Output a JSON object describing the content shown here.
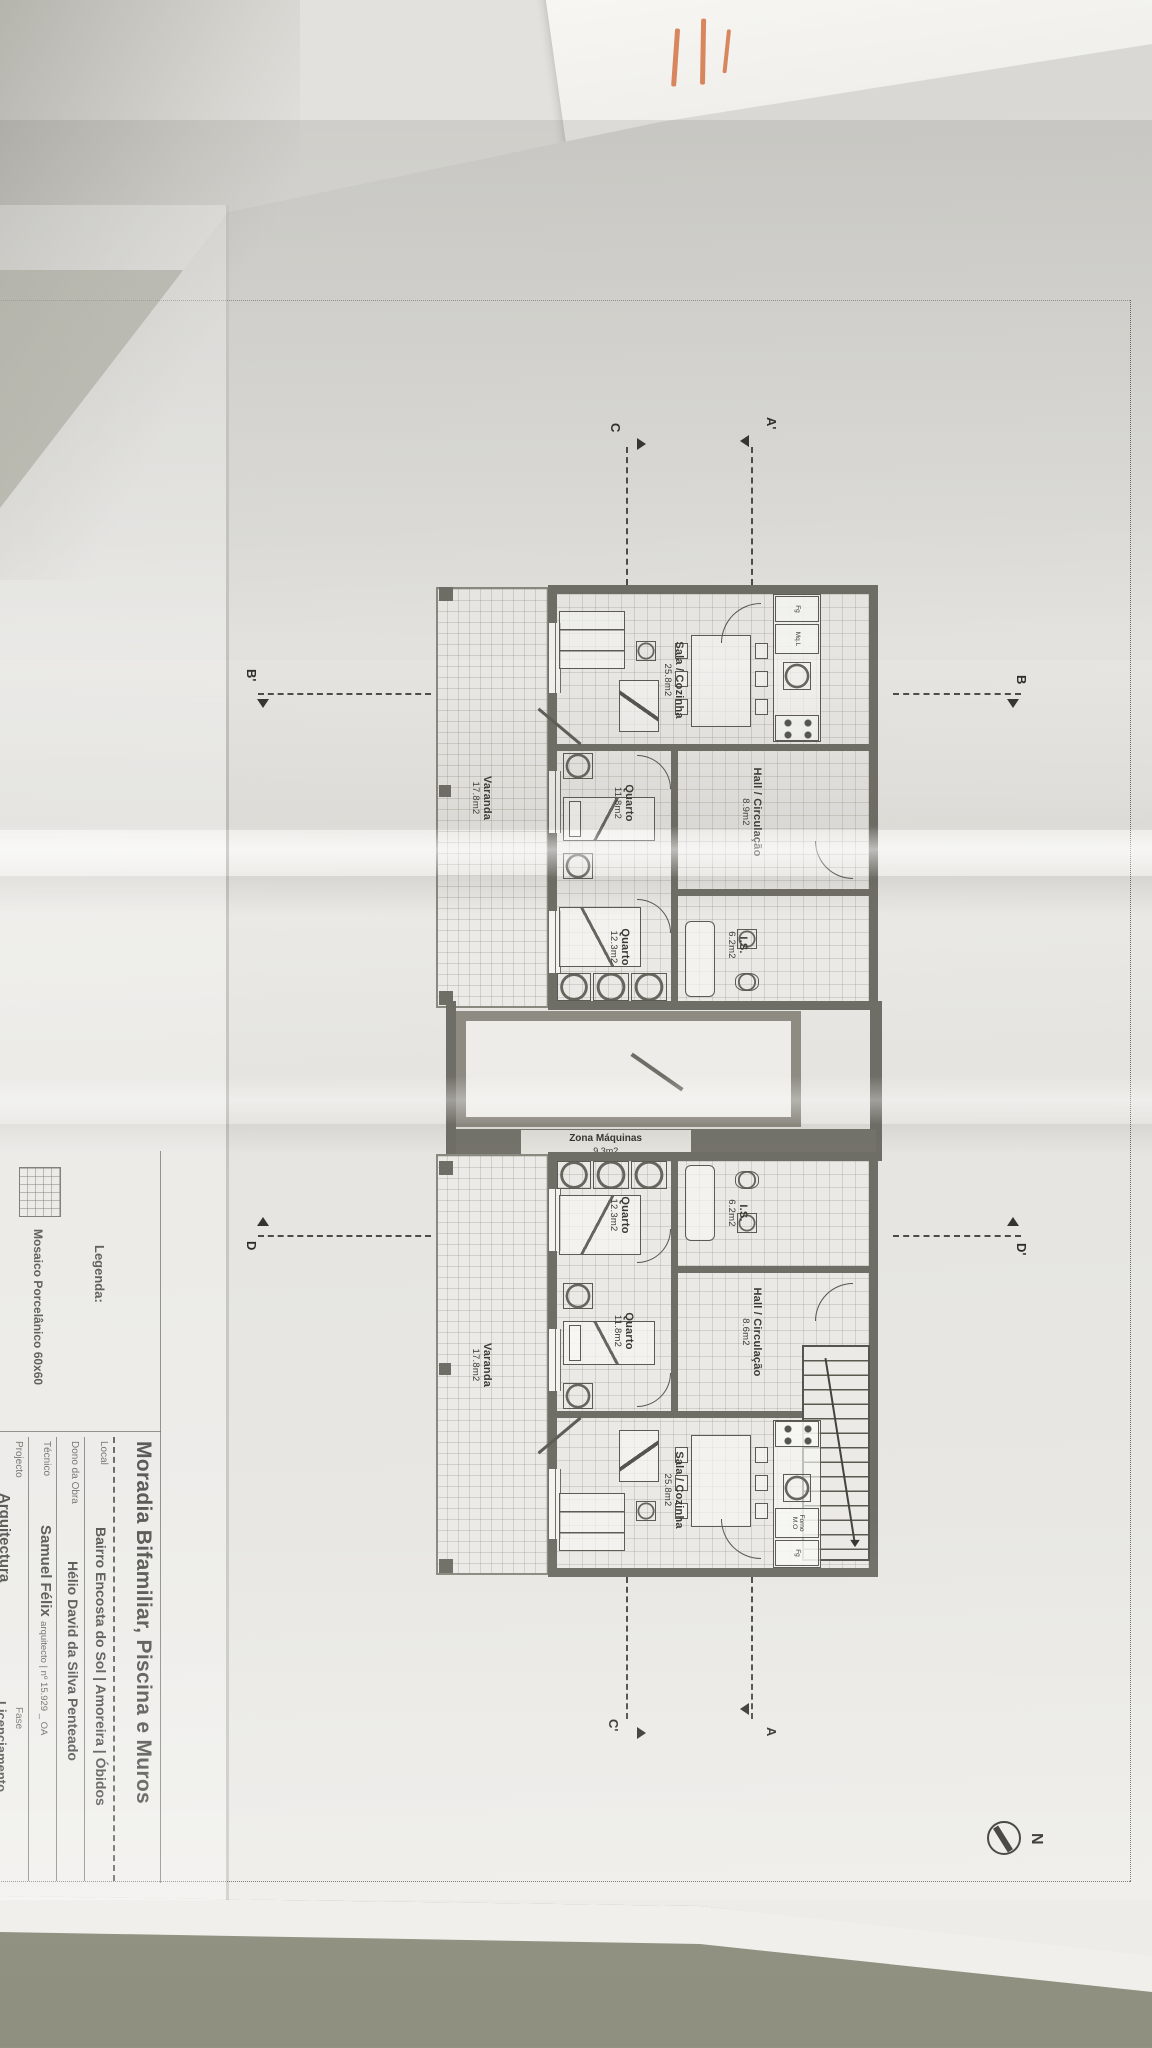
{
  "scene": {
    "table_color": "#9c9c8e",
    "paper_color": "#e7e6e2",
    "envelope_ink_color": "#d06a38"
  },
  "sheet": {
    "north_label": "N",
    "markers": {
      "c": "C",
      "a_prime": "A'",
      "b": "B",
      "d_prime": "D'",
      "c_prime": "C'",
      "a": "A",
      "b_prime": "B'",
      "d": "D"
    },
    "zona": {
      "name": "Zona Máquinas",
      "area": "9.3m2"
    },
    "unit_a": {
      "sala": {
        "name": "Sala / Cozinha",
        "area": "25.8m2"
      },
      "hall": {
        "name": "Hall / Circulação",
        "area": "8.9m2"
      },
      "quarto1": {
        "name": "Quarto",
        "area": "11.8m2"
      },
      "quarto2": {
        "name": "Quarto",
        "area": "12.3m2"
      },
      "is": {
        "name": "I.S.",
        "area": "6.2m2"
      },
      "varanda": {
        "name": "Varanda",
        "area": "17.8m2"
      },
      "appliances": {
        "a1": "Fg",
        "a2": "Mq.L"
      }
    },
    "unit_b": {
      "sala": {
        "name": "Sala / Cozinha",
        "area": "25.8m2"
      },
      "hall": {
        "name": "Hall / Circulação",
        "area": "8.6m2"
      },
      "quarto1": {
        "name": "Quarto",
        "area": "11.8m2"
      },
      "quarto2": {
        "name": "Quarto",
        "area": "12.3m2"
      },
      "is": {
        "name": "I.S.",
        "area": "6.2m2"
      },
      "varanda": {
        "name": "Varanda",
        "area": "17.8m2"
      },
      "appliances": {
        "a1": "Forno M.O",
        "a2": "Fg"
      }
    },
    "legend": {
      "heading": "Legenda:",
      "item1": "Mosaico Porcelânico 60x60"
    },
    "title_block": {
      "title": "Moradia Bifamiliar, Piscina e Muros",
      "local_label": "Local",
      "local_value": "Bairro Encosta do Sol | Amoreira | Óbidos",
      "dono_label": "Dono da Obra",
      "dono_value": "Hélio David da Silva Penteado",
      "tecnico_label": "Técnico",
      "tecnico_value": "Samuel Félix",
      "tecnico_suffix": "arquitecto | nº 15.929 _ OA",
      "projecto_label": "Projecto",
      "projecto_value": "Arquitectura",
      "fase_label": "Fase",
      "fase_value": "Licenciamento"
    }
  }
}
